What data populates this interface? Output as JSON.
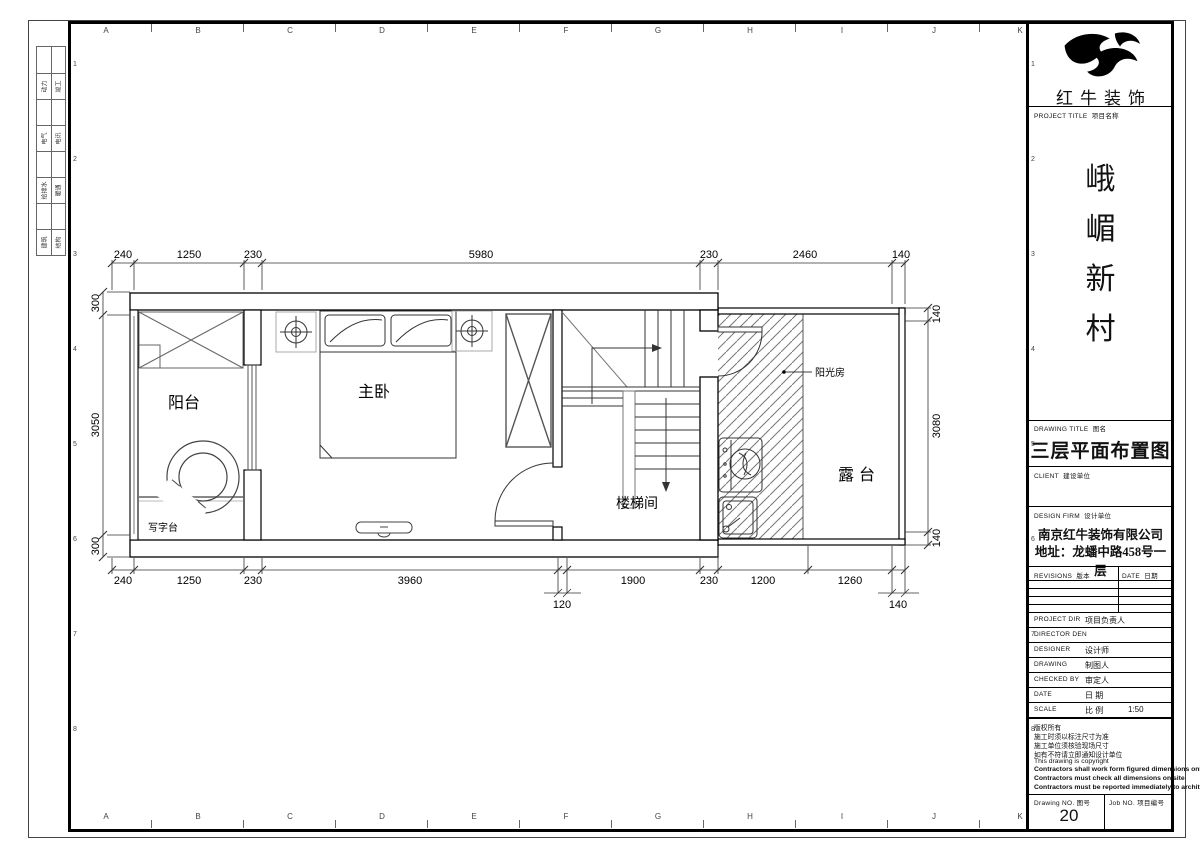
{
  "sheet": {
    "top_ruler_letters": [
      "A",
      "B",
      "C",
      "D",
      "E",
      "F",
      "G",
      "H",
      "I",
      "J",
      "K"
    ],
    "bottom_ruler_letters": [
      "A",
      "B",
      "C",
      "D",
      "E",
      "F",
      "G",
      "H",
      "I",
      "J",
      "K"
    ],
    "row_numbers": [
      "1",
      "2",
      "3",
      "4",
      "5",
      "6",
      "7",
      "8"
    ],
    "discipline_cells": [
      [
        "动力",
        "竣工"
      ],
      [
        "电气",
        "电讯"
      ],
      [
        "给排水",
        "暖通"
      ],
      [
        "建筑",
        "结构"
      ]
    ]
  },
  "plan": {
    "rooms": {
      "balcony": "阳台",
      "master_bedroom": "主卧",
      "stairwell": "楼梯间",
      "desk": "写字台",
      "sunroom": "阳光房",
      "terrace": "露台"
    },
    "dimensions": {
      "top": [
        "240",
        "1250",
        "230",
        "5980",
        "230",
        "2460",
        "140"
      ],
      "bottom": [
        "240",
        "1250",
        "230",
        "3960",
        "1900",
        "230",
        "1200",
        "1260"
      ],
      "bottom_offset_120": "120",
      "bottom_offset_140": "140",
      "left": [
        "300",
        "3050",
        "300"
      ],
      "right": [
        "140",
        "3080",
        "140"
      ]
    }
  },
  "title_block": {
    "logo_text": "红牛装饰",
    "project_title_label": "PROJECT TITLE",
    "project_title_label_cn": "项目名称",
    "project_name_chars": [
      "峨",
      "嵋",
      "新",
      "村"
    ],
    "drawing_title_label": "DRAWING TITLE",
    "drawing_title_label_cn": "图名",
    "drawing_title": "三层平面布置图",
    "client_label": "CLIENT",
    "client_label_cn": "建设单位",
    "design_firm_label": "DESIGN FIRM",
    "design_firm_label_cn": "设计单位",
    "design_firm_name": "南京红牛装饰有限公司",
    "design_firm_address": "地址：龙蟠中路458号一层",
    "revisions_label": "REVISIONS",
    "revisions_label_cn": "版本",
    "date_col_label": "DATE",
    "date_col_label_cn": "日期",
    "fields": [
      {
        "label": "PROJECT DIR",
        "cn": "项目负责人",
        "value": ""
      },
      {
        "label": "DIRECTOR DEN",
        "cn": "",
        "value": ""
      },
      {
        "label": "DESIGNER",
        "cn": "设计师",
        "value": ""
      },
      {
        "label": "DRAWING",
        "cn": "制图人",
        "value": ""
      },
      {
        "label": "CHECKED BY",
        "cn": "审定人",
        "value": ""
      },
      {
        "label": "DATE",
        "cn": "日 期",
        "value": ""
      },
      {
        "label": "SCALE",
        "cn": "比 例",
        "value": "1:50"
      }
    ],
    "notes": [
      "版权所有",
      "施工时须以标注尺寸为准",
      "施工单位须核验现场尺寸",
      "如有不符请立即通知设计单位",
      "This drawing is copyright",
      "Contractors shall work form figured dimensions only",
      "Contractors must check all dimensions on site",
      "Contractors must be reported immediately to architects"
    ],
    "drawing_no_label": "Drawing NO.",
    "drawing_no_label_cn": "图号",
    "drawing_no": "20",
    "job_no_label": "Job NO.",
    "job_no_label_cn": "项目编号"
  }
}
